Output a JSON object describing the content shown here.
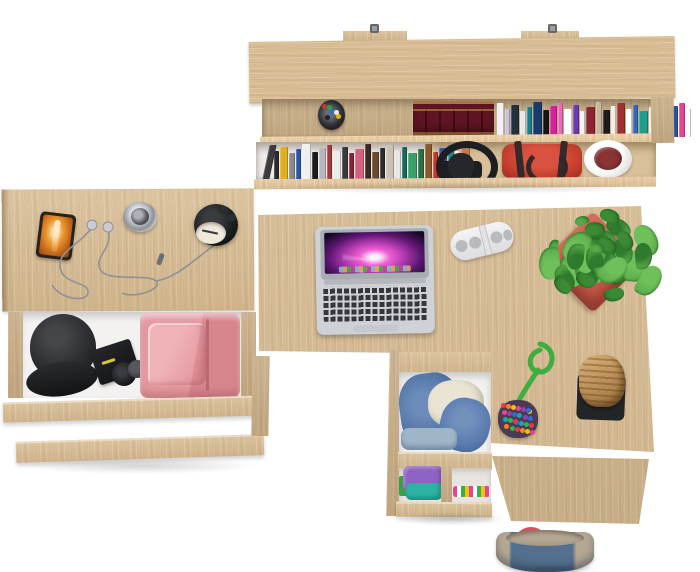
{
  "scene": {
    "label": "Top view 3D render of a light-oak home office furniture set",
    "background": "#ffffff",
    "palette": {
      "wood": "#d8bd94",
      "wood_dark": "#c7ab81",
      "wood_edge": "#e6d2ad",
      "background": "#ffffff"
    },
    "wall_shelf": {
      "label": "wall shelf with two book rows",
      "bracket_color": "#9aa0a5",
      "pen_cup": {
        "cup": "#2b2c30",
        "pens": [
          "#d23333",
          "#2a6fd6",
          "#eab308",
          "#2f9e44",
          "#ededed",
          "#222222"
        ]
      },
      "leather_books": {
        "spine": "#5e1421",
        "gold": "#c9a24b"
      },
      "top_row_books": [
        "#f2f2f2",
        "#c9c2dd",
        "#22303f",
        "#e8e8e8",
        "#157f8d",
        "#1a3a6b",
        "#141414",
        "#d6219c",
        "#e86ab8",
        "#ffffff",
        "#6a3ab2",
        "#f5f5f5",
        "#8c2433",
        "#c9b69c",
        "#1c1c1c",
        "#f0eee8",
        "#a03030",
        "#ffffff",
        "#3566b8",
        "#1f9e8e",
        "#efefef",
        "#2c2c2c",
        "#2d8a4a",
        "#2255aa",
        "#e84393",
        "#fafafa"
      ],
      "bottom_row_books": [
        "#3c3c40",
        "#2b2b2e",
        "#e2b01f",
        "#8a8a8e",
        "#2a55a8",
        "#efefef",
        "#1b1b1e",
        "#b8b8bc",
        "#a33a3a",
        "#ececec",
        "#3a3a3e",
        "#8c2333",
        "#d4627e",
        "#3b2a1f",
        "#6b4a2e",
        "#2c2c30",
        "#c9c2b2",
        "#e8e6e2",
        "#17695c",
        "#3aa06a",
        "#2c6e3f",
        "#8a5a2e",
        "#c0392b",
        "#2a55a8",
        "#1a8f8f",
        "#f0f0ee",
        "#c77950"
      ],
      "headphones_color": "#1d1e21",
      "handbag": {
        "body": "#c23b2c",
        "straps": "#342a2b"
      },
      "corner_plant": {
        "pot": "#f3f2f0",
        "plant": "#7d2f2e"
      }
    },
    "side_table": {
      "label": "side desk with open drawer",
      "phone": {
        "frame": "#26221f",
        "screen": "#d97a20"
      },
      "earphones": {
        "wire": "#8d9299",
        "buds": "#c9ccd1"
      },
      "round_clock": {
        "ring": "#c9ccd0",
        "center": "#54585e"
      },
      "alarm_clock": {
        "body": "#1b1c1e",
        "face": "#efe9da"
      },
      "drawer": {
        "interior": "#f3f2f1",
        "cap": "#2d2e31",
        "box": "#17181b",
        "bottle": "#101114",
        "pants": "#e59aa1"
      }
    },
    "desk": {
      "label": "corner desk",
      "laptop": {
        "body": "#ced2d6",
        "bezel": "#a8adb2",
        "keys": "#35373b",
        "trackpad": "#c5c9cd"
      },
      "power_strip": {
        "body": "#ebebed",
        "sockets": "#b9babe"
      },
      "plant": {
        "pot": "#c05747",
        "leaves": [
          "#3c8a34",
          "#55a946",
          "#6fbf5b",
          "#2f7a2c"
        ]
      },
      "pompom_toy": {
        "cord": "#3fae3f",
        "base": "#4a3b52",
        "dots": [
          "#e63946",
          "#2a6fd6",
          "#f4c20d",
          "#36b24a",
          "#8e44ad",
          "#ff7f2a",
          "#1aa6b7",
          "#e84393"
        ]
      },
      "cork_stool": {
        "cork": "#b8894e",
        "mat": "#232426"
      },
      "hanging_bag": {
        "denim": "#53708e",
        "trim": "#b5a893",
        "handles": "#d95055"
      }
    },
    "drawer_unit": {
      "label": "pulled-out drawer unit",
      "top_drawer": {
        "interior": "#f2f1ef",
        "denim": "#50719f",
        "denim_light": "#5a7bb0",
        "sweater": "#e9e4d4",
        "light_blue": "#9fb6c8"
      },
      "lower_shelf": {
        "back": "#e8e4df",
        "purple": "#8d63c4",
        "teal": "#2db3a3",
        "green": "#3aa04c",
        "stripes": [
          "#e84393",
          "#ffffff",
          "#36b24a",
          "#f4c20d"
        ]
      }
    }
  }
}
